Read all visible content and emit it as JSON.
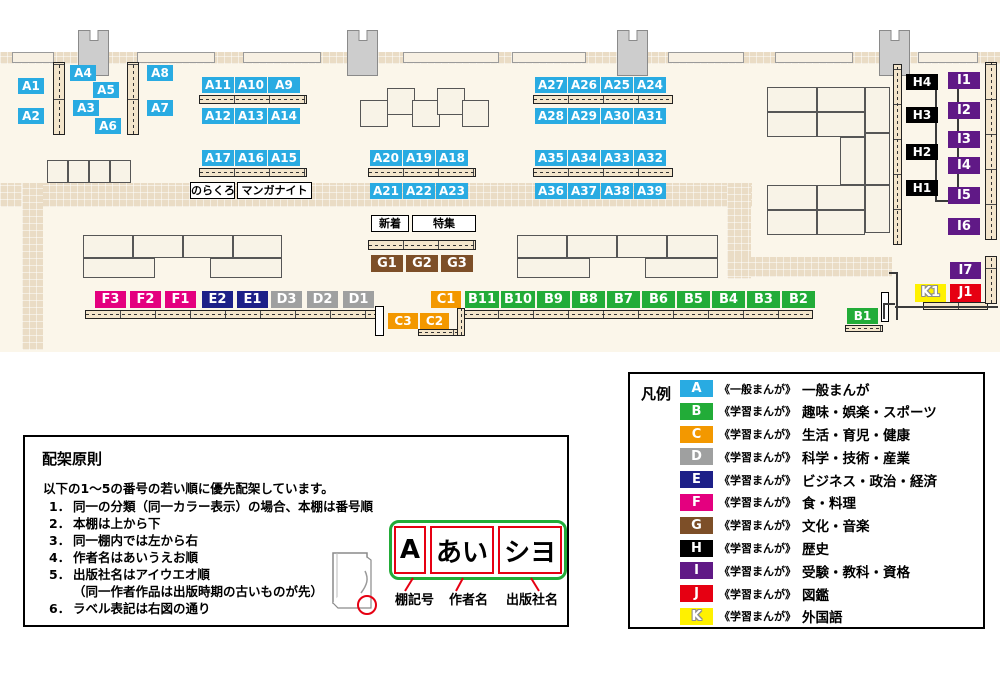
{
  "colors": {
    "A": "#29abe2",
    "B": "#22ac38",
    "C": "#f39800",
    "D": "#9fa0a0",
    "E": "#1d2088",
    "F": "#e4007f",
    "G": "#7d4f28",
    "H": "#000000",
    "I": "#601986",
    "J": "#e60012",
    "K": "#fff100"
  },
  "map": {
    "shelf_labels": [
      {
        "id": "A1",
        "c": "A",
        "x": 18,
        "y": 78,
        "w": 26,
        "h": 16
      },
      {
        "id": "A2",
        "c": "A",
        "x": 18,
        "y": 108,
        "w": 26,
        "h": 16
      },
      {
        "id": "A4",
        "c": "A",
        "x": 70,
        "y": 65,
        "w": 26,
        "h": 16
      },
      {
        "id": "A5",
        "c": "A",
        "x": 93,
        "y": 82,
        "w": 26,
        "h": 16
      },
      {
        "id": "A3",
        "c": "A",
        "x": 73,
        "y": 100,
        "w": 26,
        "h": 16
      },
      {
        "id": "A6",
        "c": "A",
        "x": 95,
        "y": 118,
        "w": 26,
        "h": 16
      },
      {
        "id": "A8",
        "c": "A",
        "x": 147,
        "y": 65,
        "w": 26,
        "h": 16
      },
      {
        "id": "A7",
        "c": "A",
        "x": 147,
        "y": 100,
        "w": 26,
        "h": 16
      },
      {
        "id": "A11",
        "c": "A",
        "x": 202,
        "y": 77,
        "w": 32,
        "h": 16
      },
      {
        "id": "A10",
        "c": "A",
        "x": 235,
        "y": 77,
        "w": 32,
        "h": 16
      },
      {
        "id": "A9",
        "c": "A",
        "x": 268,
        "y": 77,
        "w": 32,
        "h": 16
      },
      {
        "id": "A12",
        "c": "A",
        "x": 202,
        "y": 108,
        "w": 32,
        "h": 16
      },
      {
        "id": "A13",
        "c": "A",
        "x": 235,
        "y": 108,
        "w": 32,
        "h": 16
      },
      {
        "id": "A14",
        "c": "A",
        "x": 268,
        "y": 108,
        "w": 32,
        "h": 16
      },
      {
        "id": "A17",
        "c": "A",
        "x": 202,
        "y": 150,
        "w": 32,
        "h": 16
      },
      {
        "id": "A16",
        "c": "A",
        "x": 235,
        "y": 150,
        "w": 32,
        "h": 16
      },
      {
        "id": "A15",
        "c": "A",
        "x": 268,
        "y": 150,
        "w": 32,
        "h": 16
      },
      {
        "id": "A20",
        "c": "A",
        "x": 370,
        "y": 150,
        "w": 32,
        "h": 16
      },
      {
        "id": "A19",
        "c": "A",
        "x": 403,
        "y": 150,
        "w": 32,
        "h": 16
      },
      {
        "id": "A18",
        "c": "A",
        "x": 436,
        "y": 150,
        "w": 32,
        "h": 16
      },
      {
        "id": "A21",
        "c": "A",
        "x": 370,
        "y": 183,
        "w": 32,
        "h": 16
      },
      {
        "id": "A22",
        "c": "A",
        "x": 403,
        "y": 183,
        "w": 32,
        "h": 16
      },
      {
        "id": "A23",
        "c": "A",
        "x": 436,
        "y": 183,
        "w": 32,
        "h": 16
      },
      {
        "id": "A27",
        "c": "A",
        "x": 535,
        "y": 77,
        "w": 32,
        "h": 16
      },
      {
        "id": "A26",
        "c": "A",
        "x": 568,
        "y": 77,
        "w": 32,
        "h": 16
      },
      {
        "id": "A25",
        "c": "A",
        "x": 601,
        "y": 77,
        "w": 32,
        "h": 16
      },
      {
        "id": "A24",
        "c": "A",
        "x": 634,
        "y": 77,
        "w": 32,
        "h": 16
      },
      {
        "id": "A28",
        "c": "A",
        "x": 535,
        "y": 108,
        "w": 32,
        "h": 16
      },
      {
        "id": "A29",
        "c": "A",
        "x": 568,
        "y": 108,
        "w": 32,
        "h": 16
      },
      {
        "id": "A30",
        "c": "A",
        "x": 601,
        "y": 108,
        "w": 32,
        "h": 16
      },
      {
        "id": "A31",
        "c": "A",
        "x": 634,
        "y": 108,
        "w": 32,
        "h": 16
      },
      {
        "id": "A35",
        "c": "A",
        "x": 535,
        "y": 150,
        "w": 32,
        "h": 16
      },
      {
        "id": "A34",
        "c": "A",
        "x": 568,
        "y": 150,
        "w": 32,
        "h": 16
      },
      {
        "id": "A33",
        "c": "A",
        "x": 601,
        "y": 150,
        "w": 32,
        "h": 16
      },
      {
        "id": "A32",
        "c": "A",
        "x": 634,
        "y": 150,
        "w": 32,
        "h": 16
      },
      {
        "id": "A36",
        "c": "A",
        "x": 535,
        "y": 183,
        "w": 32,
        "h": 16
      },
      {
        "id": "A37",
        "c": "A",
        "x": 568,
        "y": 183,
        "w": 32,
        "h": 16
      },
      {
        "id": "A38",
        "c": "A",
        "x": 601,
        "y": 183,
        "w": 32,
        "h": 16
      },
      {
        "id": "A39",
        "c": "A",
        "x": 634,
        "y": 183,
        "w": 32,
        "h": 16
      },
      {
        "id": "G1",
        "c": "G",
        "x": 371,
        "y": 255,
        "w": 32,
        "h": 17
      },
      {
        "id": "G2",
        "c": "G",
        "x": 406,
        "y": 255,
        "w": 32,
        "h": 17
      },
      {
        "id": "G3",
        "c": "G",
        "x": 441,
        "y": 255,
        "w": 32,
        "h": 17
      },
      {
        "id": "F3",
        "c": "F",
        "x": 95,
        "y": 291,
        "w": 31,
        "h": 17
      },
      {
        "id": "F2",
        "c": "F",
        "x": 130,
        "y": 291,
        "w": 31,
        "h": 17
      },
      {
        "id": "F1",
        "c": "F",
        "x": 165,
        "y": 291,
        "w": 31,
        "h": 17
      },
      {
        "id": "E2",
        "c": "E",
        "x": 202,
        "y": 291,
        "w": 31,
        "h": 17
      },
      {
        "id": "E1",
        "c": "E",
        "x": 237,
        "y": 291,
        "w": 31,
        "h": 17
      },
      {
        "id": "D3",
        "c": "D",
        "x": 271,
        "y": 291,
        "w": 31,
        "h": 17
      },
      {
        "id": "D2",
        "c": "D",
        "x": 307,
        "y": 291,
        "w": 31,
        "h": 17
      },
      {
        "id": "D1",
        "c": "D",
        "x": 343,
        "y": 291,
        "w": 31,
        "h": 17
      },
      {
        "id": "C1",
        "c": "C",
        "x": 431,
        "y": 291,
        "w": 30,
        "h": 17
      },
      {
        "id": "C3",
        "c": "C",
        "x": 388,
        "y": 313,
        "w": 30,
        "h": 16
      },
      {
        "id": "C2",
        "c": "C",
        "x": 420,
        "y": 313,
        "w": 29,
        "h": 16
      },
      {
        "id": "B11",
        "c": "B",
        "x": 465,
        "y": 291,
        "w": 34,
        "h": 17
      },
      {
        "id": "B10",
        "c": "B",
        "x": 501,
        "y": 291,
        "w": 34,
        "h": 17
      },
      {
        "id": "B9",
        "c": "B",
        "x": 537,
        "y": 291,
        "w": 33,
        "h": 17
      },
      {
        "id": "B8",
        "c": "B",
        "x": 572,
        "y": 291,
        "w": 33,
        "h": 17
      },
      {
        "id": "B7",
        "c": "B",
        "x": 607,
        "y": 291,
        "w": 33,
        "h": 17
      },
      {
        "id": "B6",
        "c": "B",
        "x": 642,
        "y": 291,
        "w": 33,
        "h": 17
      },
      {
        "id": "B5",
        "c": "B",
        "x": 677,
        "y": 291,
        "w": 33,
        "h": 17
      },
      {
        "id": "B4",
        "c": "B",
        "x": 712,
        "y": 291,
        "w": 33,
        "h": 17
      },
      {
        "id": "B3",
        "c": "B",
        "x": 747,
        "y": 291,
        "w": 33,
        "h": 17
      },
      {
        "id": "B2",
        "c": "B",
        "x": 782,
        "y": 291,
        "w": 33,
        "h": 17
      },
      {
        "id": "B1",
        "c": "B",
        "x": 847,
        "y": 308,
        "w": 31,
        "h": 16
      },
      {
        "id": "H4",
        "c": "H",
        "x": 906,
        "y": 74,
        "w": 32,
        "h": 16
      },
      {
        "id": "H3",
        "c": "H",
        "x": 906,
        "y": 107,
        "w": 32,
        "h": 16
      },
      {
        "id": "H2",
        "c": "H",
        "x": 906,
        "y": 144,
        "w": 32,
        "h": 16
      },
      {
        "id": "H1",
        "c": "H",
        "x": 906,
        "y": 180,
        "w": 32,
        "h": 16
      },
      {
        "id": "I1",
        "c": "I",
        "x": 948,
        "y": 72,
        "w": 32,
        "h": 17
      },
      {
        "id": "I2",
        "c": "I",
        "x": 948,
        "y": 102,
        "w": 32,
        "h": 17
      },
      {
        "id": "I3",
        "c": "I",
        "x": 948,
        "y": 131,
        "w": 32,
        "h": 17
      },
      {
        "id": "I4",
        "c": "I",
        "x": 948,
        "y": 157,
        "w": 32,
        "h": 17
      },
      {
        "id": "I5",
        "c": "I",
        "x": 948,
        "y": 187,
        "w": 32,
        "h": 17
      },
      {
        "id": "I6",
        "c": "I",
        "x": 948,
        "y": 218,
        "w": 32,
        "h": 17
      },
      {
        "id": "I7",
        "c": "I",
        "x": 950,
        "y": 262,
        "w": 31,
        "h": 17
      },
      {
        "id": "K1",
        "c": "K",
        "x": 915,
        "y": 284,
        "w": 31,
        "h": 18
      },
      {
        "id": "J1",
        "c": "J",
        "x": 950,
        "y": 284,
        "w": 31,
        "h": 18
      }
    ],
    "callouts": [
      {
        "text": "のらくろ",
        "x": 190,
        "y": 182,
        "w": 45,
        "h": 17
      },
      {
        "text": "マンガナイト",
        "x": 237,
        "y": 182,
        "w": 75,
        "h": 17
      },
      {
        "text": "新着",
        "x": 371,
        "y": 215,
        "w": 38,
        "h": 17
      },
      {
        "text": "特集",
        "x": 412,
        "y": 215,
        "w": 64,
        "h": 17
      }
    ]
  },
  "legend": {
    "title": "凡例",
    "items": [
      {
        "code": "A",
        "type": "《一般まんが》",
        "category": "一般まんが"
      },
      {
        "code": "B",
        "type": "《学習まんが》",
        "category": "趣味・娯楽・スポーツ"
      },
      {
        "code": "C",
        "type": "《学習まんが》",
        "category": "生活・育児・健康"
      },
      {
        "code": "D",
        "type": "《学習まんが》",
        "category": "科学・技術・産業"
      },
      {
        "code": "E",
        "type": "《学習まんが》",
        "category": "ビジネス・政治・経済"
      },
      {
        "code": "F",
        "type": "《学習まんが》",
        "category": "食・料理"
      },
      {
        "code": "G",
        "type": "《学習まんが》",
        "category": "文化・音楽"
      },
      {
        "code": "H",
        "type": "《学習まんが》",
        "category": "歴史"
      },
      {
        "code": "I",
        "type": "《学習まんが》",
        "category": "受験・教科・資格"
      },
      {
        "code": "J",
        "type": "《学習まんが》",
        "category": "図鑑"
      },
      {
        "code": "K",
        "type": "《学習まんが》",
        "category": "外国語"
      }
    ]
  },
  "principles": {
    "title": "配架原則",
    "intro": "以下の1～5の番号の若い順に優先配架しています。",
    "rules": [
      {
        "num": "1．",
        "text": "同一の分類（同一カラー表示）の場合、本棚は番号順"
      },
      {
        "num": "2．",
        "text": "本棚は上から下"
      },
      {
        "num": "3．",
        "text": "同一棚内では左から右"
      },
      {
        "num": "4．",
        "text": "作者名はあいうえお順"
      },
      {
        "num": "5．",
        "text": "出版社名はアイウエオ順",
        "sub": "（同一作者作品は出版時期の古いものが先）"
      },
      {
        "num": "6．",
        "text": "ラベル表記は右図の通り"
      }
    ],
    "label_diagram": {
      "segments": [
        "A",
        "あい",
        "シヨ"
      ],
      "captions": [
        "棚記号",
        "作者名",
        "出版社名"
      ]
    }
  }
}
